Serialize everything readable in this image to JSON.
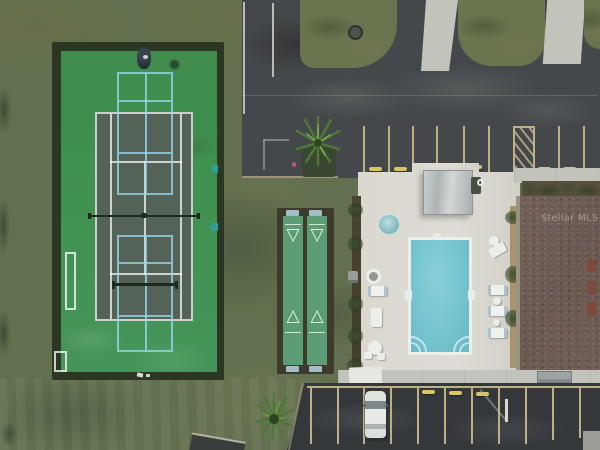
{
  "scene": {
    "type": "aerial-drone-photo",
    "description": "Overhead aerial view of community recreation amenities: a green tennis court with light-blue pickleball overlay, two shuffleboard courts, a rectangular swimming pool with spa and shade pavilion on a white sun deck, a brown shingle clubhouse roof, asphalt drives and parking stalls with a single white parked car, lawns, hedges and palm trees.",
    "watermark": "Stellar MLS"
  },
  "areas": {
    "tennis_court": {
      "label": "tennis court with pickleball overlay and portable pickleball net",
      "apron_color": "#419150",
      "inner_color": "#546257",
      "tennis_line_color": "#ffffff",
      "pickleball_line_color": "#96d6e9"
    },
    "shuffleboard": {
      "label": "two shuffleboard courts with scoring triangles and end benches",
      "court_color": "#5c9c74",
      "frame_color": "#3e3a2c",
      "triangle_down": "▽",
      "triangle_up": "△"
    },
    "pool": {
      "label": "rectangular swimming pool with corner steps",
      "water_color": "#76c5d0",
      "coping_color": "#ecefea"
    },
    "spa": {
      "label": "round spa / hot tub",
      "color": "#8fc2c9"
    },
    "pool_deck": {
      "label": "concrete pool deck with loungers and tables",
      "color": "#dad8cf"
    },
    "pavilion": {
      "label": "metal shade pavilion",
      "color": "#c0c5c5"
    },
    "clubhouse": {
      "label": "clubhouse shingle roof with vents",
      "roof_color": "#6e5c55",
      "vent_color": "#7d4a3c"
    },
    "parking": {
      "label": "asphalt drive and parking stalls",
      "asphalt_color": "#45484a",
      "stall_line_color": "#bdb086",
      "wheel_stop_color": "#d9c564"
    },
    "car": {
      "label": "white car parked in lower lot",
      "color": "#e8eae7"
    },
    "vegetation": {
      "label": "lawn, palm trees, hedges and grass island",
      "grass_color": "#62704f"
    }
  }
}
